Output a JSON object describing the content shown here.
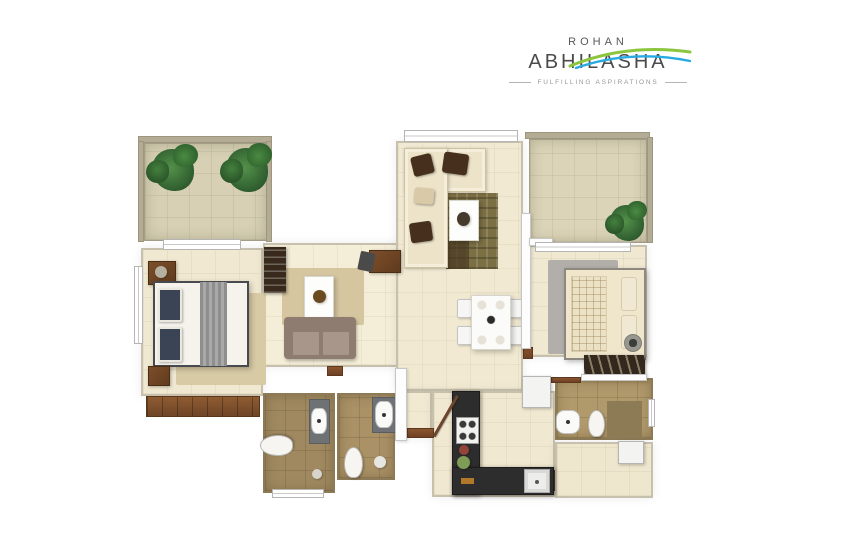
{
  "logo": {
    "brand": "ROHAN",
    "name": "ABHILASHA",
    "tagline": "FULFILLING ASPIRATIONS",
    "text_color": "#4b4b4d",
    "swoosh_green": "#8cc63f",
    "swoosh_blue": "#29abe2"
  },
  "palette": {
    "page_bg": "#ffffff",
    "floor_cream": "#f0e8d0",
    "balcony_khaki": "#d7d0b4",
    "bath_tile": "#a08960",
    "wood": "#7a4a28",
    "counter_black": "#2d2d2d",
    "wall_white": "#fdfdfd",
    "plant_green": "#3a6b35"
  },
  "floorplan": {
    "description": "3D top-view apartment floor plan render, no room labels",
    "elements": [
      {
        "n": "balcony-left-floor",
        "t": "room-balcony",
        "x": 144,
        "y": 143,
        "w": 123,
        "h": 98,
        "bg": "#d7d0b4"
      },
      {
        "n": "bedroom-master-floor",
        "t": "room",
        "x": 141,
        "y": 248,
        "w": 122,
        "h": 148,
        "bg": "#f0e8d0"
      },
      {
        "n": "living-left-floor",
        "t": "room",
        "x": 263,
        "y": 243,
        "w": 137,
        "h": 124,
        "bg": "#f4edd7"
      },
      {
        "n": "living-dining-floor",
        "t": "room",
        "x": 396,
        "y": 141,
        "w": 127,
        "h": 250,
        "bg": "#f1e9d1"
      },
      {
        "n": "entry-passage-floor",
        "t": "room",
        "x": 405,
        "y": 391,
        "w": 27,
        "h": 47,
        "bg": "#f1e9d1"
      },
      {
        "n": "kitchen-floor",
        "t": "room",
        "x": 432,
        "y": 391,
        "w": 123,
        "h": 106,
        "bg": "#f0e8d0"
      },
      {
        "n": "balcony-right-floor",
        "t": "room-balcony",
        "x": 529,
        "y": 139,
        "w": 118,
        "h": 104,
        "bg": "#dbd4b8"
      },
      {
        "n": "bedroom-2-floor",
        "t": "room",
        "x": 525,
        "y": 245,
        "w": 122,
        "h": 112,
        "bg": "#f0e8d0"
      },
      {
        "n": "bath-1-floor",
        "t": "room-bath",
        "x": 263,
        "y": 393,
        "w": 72,
        "h": 100,
        "bg": "#a08960"
      },
      {
        "n": "bath-2-floor",
        "t": "room-bath",
        "x": 337,
        "y": 393,
        "w": 58,
        "h": 87,
        "bg": "#aa9166"
      },
      {
        "n": "bath-3-floor",
        "t": "room-bath",
        "x": 555,
        "y": 378,
        "w": 98,
        "h": 62,
        "bg": "#b0996b"
      },
      {
        "n": "utility-floor",
        "t": "room",
        "x": 555,
        "y": 442,
        "w": 98,
        "h": 56,
        "bg": "#eee6cd"
      },
      {
        "n": "balcony-left-wall-top",
        "t": "wallk",
        "x": 138,
        "y": 136,
        "w": 134,
        "h": 7
      },
      {
        "n": "balcony-left-wall-left",
        "t": "wallk",
        "x": 138,
        "y": 141,
        "w": 6,
        "h": 101
      },
      {
        "n": "balcony-left-wall-right",
        "t": "wallk",
        "x": 266,
        "y": 141,
        "w": 6,
        "h": 101
      },
      {
        "n": "balcony-right-wall-top",
        "t": "wallk",
        "x": 525,
        "y": 132,
        "w": 125,
        "h": 7
      },
      {
        "n": "balcony-right-wall-right",
        "t": "wallk",
        "x": 647,
        "y": 137,
        "w": 6,
        "h": 106
      },
      {
        "n": "master-wardrobe-wood-strip",
        "t": "wood",
        "x": 146,
        "y": 396,
        "w": 114,
        "h": 21
      },
      {
        "n": "threshold-living-left",
        "t": "thresh",
        "x": 327,
        "y": 366,
        "w": 16,
        "h": 10
      },
      {
        "n": "threshold-entry",
        "t": "thresh",
        "x": 407,
        "y": 428,
        "w": 27,
        "h": 10
      },
      {
        "n": "threshold-bedroom-2",
        "t": "thresh",
        "x": 523,
        "y": 347,
        "w": 10,
        "h": 12
      },
      {
        "n": "threshold-bath-3",
        "t": "thresh",
        "x": 551,
        "y": 377,
        "w": 30,
        "h": 6
      },
      {
        "n": "threshold-utility",
        "t": "thresh",
        "x": 547,
        "y": 470,
        "w": 8,
        "h": 21
      },
      {
        "n": "master-rug",
        "t": "rug",
        "x": 176,
        "y": 293,
        "w": 90,
        "h": 92,
        "bg": "#d7caa4"
      },
      {
        "n": "living-left-rug",
        "t": "rug",
        "x": 282,
        "y": 268,
        "w": 82,
        "h": 57,
        "bg": "#d5c6a0"
      },
      {
        "n": "living-center-rug",
        "t": "rug-pattern",
        "x": 446,
        "y": 193,
        "w": 52,
        "h": 76
      },
      {
        "n": "bedroom-2-rug",
        "t": "rug",
        "x": 548,
        "y": 260,
        "w": 70,
        "h": 94,
        "bg": "#b2afaa"
      },
      {
        "n": "nightstand-top",
        "t": "wood-box",
        "x": 148,
        "y": 261,
        "w": 28,
        "h": 24
      },
      {
        "n": "table-lamp",
        "t": "circle",
        "x": 155,
        "y": 266,
        "w": 12,
        "h": 12,
        "bg": "#b5b0a2"
      },
      {
        "n": "master-bed",
        "t": "bed-white",
        "x": 153,
        "y": 281,
        "w": 96,
        "h": 86
      },
      {
        "n": "master-pillow-1",
        "t": "pillow-navy",
        "x": 158,
        "y": 288,
        "w": 24,
        "h": 34
      },
      {
        "n": "master-pillow-2",
        "t": "pillow-navy",
        "x": 158,
        "y": 327,
        "w": 24,
        "h": 35
      },
      {
        "n": "master-throw",
        "t": "throw",
        "x": 200,
        "y": 282,
        "w": 27,
        "h": 84
      },
      {
        "n": "nightstand-bottom",
        "t": "wood-box",
        "x": 148,
        "y": 366,
        "w": 22,
        "h": 20
      },
      {
        "n": "tv-unit-wardrobe",
        "t": "wardrobe-dark",
        "x": 264,
        "y": 247,
        "w": 22,
        "h": 46
      },
      {
        "n": "coffee-table-left",
        "t": "table-white",
        "x": 304,
        "y": 276,
        "w": 30,
        "h": 42
      },
      {
        "n": "table-plant-pot",
        "t": "circle",
        "x": 313,
        "y": 290,
        "w": 13,
        "h": 13,
        "bg": "#6b4a20"
      },
      {
        "n": "sofa-left-back",
        "t": "sofa-back",
        "x": 284,
        "y": 317,
        "w": 72,
        "h": 42
      },
      {
        "n": "sofa-left-seat-1",
        "t": "sofa-seat",
        "x": 292,
        "y": 331,
        "w": 28,
        "h": 25
      },
      {
        "n": "sofa-left-seat-2",
        "t": "sofa-seat",
        "x": 322,
        "y": 331,
        "w": 28,
        "h": 25
      },
      {
        "n": "study-desk",
        "t": "wood-box",
        "x": 369,
        "y": 250,
        "w": 32,
        "h": 23,
        "bg": "#55391f"
      },
      {
        "n": "desk-chair",
        "t": "chair-dark",
        "x": 359,
        "y": 252,
        "w": 15,
        "h": 19,
        "r": 12
      },
      {
        "n": "l-sofa-horizontal",
        "t": "sofa-cream",
        "x": 404,
        "y": 148,
        "w": 82,
        "h": 44
      },
      {
        "n": "l-sofa-vertical",
        "t": "sofa-cream",
        "x": 404,
        "y": 148,
        "w": 44,
        "h": 120
      },
      {
        "n": "sofa-cushion-1",
        "t": "cushion",
        "x": 412,
        "y": 155,
        "w": 21,
        "h": 20,
        "r": -14
      },
      {
        "n": "sofa-cushion-2",
        "t": "cushion",
        "x": 443,
        "y": 153,
        "w": 25,
        "h": 21,
        "r": 8
      },
      {
        "n": "sofa-cushion-3",
        "t": "cushion",
        "x": 410,
        "y": 222,
        "w": 22,
        "h": 20,
        "r": -8
      },
      {
        "n": "sofa-cushion-beige",
        "t": "cushion",
        "x": 414,
        "y": 188,
        "w": 20,
        "h": 16,
        "r": 5,
        "bg": "#d9c9a8"
      },
      {
        "n": "coffee-table-center",
        "t": "table-white",
        "x": 449,
        "y": 200,
        "w": 30,
        "h": 41
      },
      {
        "n": "table-decor",
        "t": "circle",
        "x": 457,
        "y": 212,
        "w": 13,
        "h": 14,
        "bg": "#453a2b"
      },
      {
        "n": "dining-chair-1",
        "t": "chair",
        "x": 457,
        "y": 299,
        "w": 15,
        "h": 19
      },
      {
        "n": "dining-chair-2",
        "t": "chair",
        "x": 457,
        "y": 326,
        "w": 15,
        "h": 19
      },
      {
        "n": "dining-chair-3",
        "t": "chair",
        "x": 508,
        "y": 299,
        "w": 15,
        "h": 19
      },
      {
        "n": "dining-chair-4",
        "t": "chair",
        "x": 508,
        "y": 326,
        "w": 15,
        "h": 19
      },
      {
        "n": "dining-table",
        "t": "dining-table",
        "x": 471,
        "y": 295,
        "w": 40,
        "h": 55
      },
      {
        "n": "kitchen-counter-left",
        "t": "counter",
        "x": 452,
        "y": 391,
        "w": 28,
        "h": 104
      },
      {
        "n": "kitchen-counter-bottom",
        "t": "counter",
        "x": 452,
        "y": 467,
        "w": 102,
        "h": 28
      },
      {
        "n": "gas-stove",
        "t": "stove",
        "x": 456,
        "y": 417,
        "w": 23,
        "h": 27
      },
      {
        "n": "kitchen-sink",
        "t": "sink",
        "x": 524,
        "y": 469,
        "w": 26,
        "h": 24
      },
      {
        "n": "kitchen-plate-red",
        "t": "circle",
        "x": 459,
        "y": 445,
        "w": 10,
        "h": 10,
        "bg": "#93443a"
      },
      {
        "n": "kitchen-plate-green",
        "t": "circle",
        "x": 457,
        "y": 456,
        "w": 13,
        "h": 13,
        "bg": "#7e9c55"
      },
      {
        "n": "kitchen-tray",
        "t": "rect",
        "x": 461,
        "y": 478,
        "w": 13,
        "h": 6,
        "bg": "#b07828"
      },
      {
        "n": "fridge",
        "t": "white-box",
        "x": 522,
        "y": 376,
        "w": 29,
        "h": 32
      },
      {
        "n": "washing-machine",
        "t": "white-box",
        "x": 618,
        "y": 441,
        "w": 26,
        "h": 23
      },
      {
        "n": "bath1-toilet",
        "t": "toilet",
        "x": 266,
        "y": 429,
        "w": 21,
        "h": 33,
        "r": -90
      },
      {
        "n": "bath1-counter",
        "t": "gray-box",
        "x": 309,
        "y": 399,
        "w": 21,
        "h": 45
      },
      {
        "n": "bath1-basin",
        "t": "basin",
        "x": 311,
        "y": 408,
        "w": 16,
        "h": 26
      },
      {
        "n": "bath1-drain",
        "t": "circle",
        "x": 312,
        "y": 469,
        "w": 10,
        "h": 10,
        "bg": "#d8d4cc"
      },
      {
        "n": "bath2-counter",
        "t": "gray-box",
        "x": 372,
        "y": 397,
        "w": 24,
        "h": 36
      },
      {
        "n": "bath2-basin",
        "t": "basin",
        "x": 375,
        "y": 401,
        "w": 18,
        "h": 27
      },
      {
        "n": "bath2-toilet",
        "t": "toilet",
        "x": 344,
        "y": 447,
        "w": 19,
        "h": 31
      },
      {
        "n": "bath2-shower-drain",
        "t": "circle",
        "x": 374,
        "y": 456,
        "w": 12,
        "h": 12,
        "bg": "#e8e6e0"
      },
      {
        "n": "bath3-dark-mat",
        "t": "rect",
        "x": 607,
        "y": 401,
        "w": 35,
        "h": 37,
        "bg": "#8d7b55"
      },
      {
        "n": "bath3-basin",
        "t": "basin",
        "x": 556,
        "y": 410,
        "w": 24,
        "h": 24
      },
      {
        "n": "bath3-toilet",
        "t": "toilet",
        "x": 588,
        "y": 410,
        "w": 17,
        "h": 27
      },
      {
        "n": "bed-2",
        "t": "bed-white",
        "x": 564,
        "y": 268,
        "w": 82,
        "h": 92,
        "bg": "#efe6cc",
        "br": "#8d8880"
      },
      {
        "n": "bed2-blanket",
        "t": "blanket-grid",
        "x": 571,
        "y": 276,
        "w": 36,
        "h": 76
      },
      {
        "n": "bed2-pillow-1",
        "t": "pillow",
        "x": 621,
        "y": 277,
        "w": 16,
        "h": 34
      },
      {
        "n": "bed2-pillow-2",
        "t": "pillow",
        "x": 621,
        "y": 315,
        "w": 16,
        "h": 34
      },
      {
        "n": "bed2-wardrobe",
        "t": "wardrobe-slash",
        "x": 584,
        "y": 355,
        "w": 61,
        "h": 21
      },
      {
        "n": "fan-fixture",
        "t": "round-fixture",
        "x": 624,
        "y": 334,
        "w": 18,
        "h": 18
      },
      {
        "n": "wall-dining-bed2",
        "t": "wall",
        "x": 521,
        "y": 213,
        "w": 10,
        "h": 136
      },
      {
        "n": "wall-bed2-branch",
        "t": "wall",
        "x": 529,
        "y": 238,
        "w": 24,
        "h": 8
      },
      {
        "n": "wall-passage-left",
        "t": "wall",
        "x": 395,
        "y": 368,
        "w": 12,
        "h": 73
      },
      {
        "n": "wall-bath3-top",
        "t": "wall",
        "x": 581,
        "y": 374,
        "w": 66,
        "h": 7
      },
      {
        "n": "window-balcony-left",
        "t": "window",
        "x": 163,
        "y": 239,
        "w": 78,
        "h": 11
      },
      {
        "n": "window-master-left",
        "t": "window",
        "x": 134,
        "y": 266,
        "w": 9,
        "h": 78
      },
      {
        "n": "window-living-top",
        "t": "window",
        "x": 404,
        "y": 130,
        "w": 114,
        "h": 12
      },
      {
        "n": "window-balcony-right",
        "t": "window",
        "x": 535,
        "y": 242,
        "w": 96,
        "h": 10
      },
      {
        "n": "window-bath1-bottom",
        "t": "window",
        "x": 272,
        "y": 489,
        "w": 52,
        "h": 9
      },
      {
        "n": "window-bath3-right",
        "t": "window",
        "x": 648,
        "y": 399,
        "w": 7,
        "h": 28
      },
      {
        "n": "plant-balcony-left-1",
        "t": "plant",
        "x": 152,
        "y": 149,
        "w": 42,
        "h": 42
      },
      {
        "n": "plant-balcony-left-2",
        "t": "plant",
        "x": 226,
        "y": 148,
        "w": 42,
        "h": 44
      },
      {
        "n": "plant-balcony-right",
        "t": "plant",
        "x": 610,
        "y": 205,
        "w": 34,
        "h": 36
      },
      {
        "n": "entry-door-leaf",
        "t": "door-leaf",
        "x": 434,
        "y": 435,
        "w": 47,
        "h": 3,
        "r": -60
      }
    ]
  }
}
